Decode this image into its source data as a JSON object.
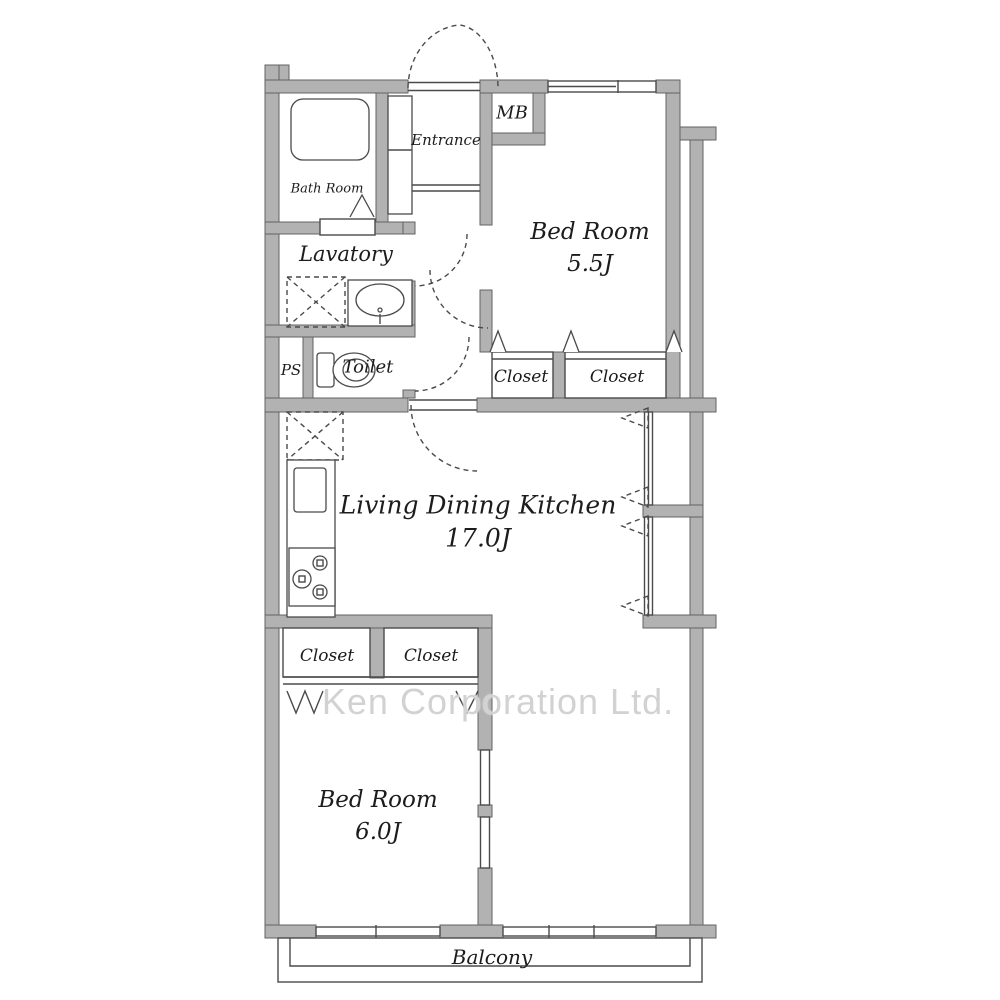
{
  "watermark": "Ken Corporation Ltd.",
  "rooms": {
    "bath": "Bath Room",
    "entrance": "Entrance",
    "mb": "MB",
    "bedroom1": "Bed Room",
    "bedroom1_size": "5.5J",
    "lavatory": "Lavatory",
    "ps": "PS",
    "toilet": "Toilet",
    "closet_b1_left": "Closet",
    "closet_b1_right": "Closet",
    "ldk": "Living Dining Kitchen",
    "ldk_size": "17.0J",
    "closet_b2_left": "Closet",
    "closet_b2_right": "Closet",
    "bedroom2": "Bed Room",
    "bedroom2_size": "6.0J",
    "balcony": "Balcony"
  }
}
